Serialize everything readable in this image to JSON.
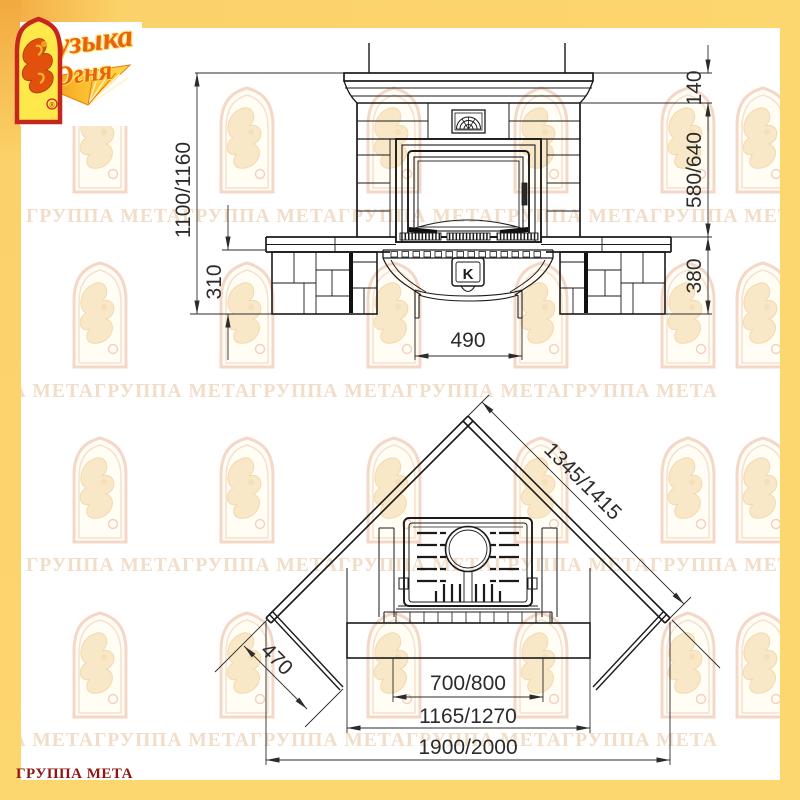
{
  "page": {
    "border_color": "#fcd66e",
    "background": "#ffffff",
    "line_color": "#1a1a1a"
  },
  "brand": {
    "logo_line1": "Музыка",
    "logo_line2": "Огня",
    "group_label": "ГРУППА МЕТА",
    "registered": "®",
    "accent_red": "#c5271f",
    "logo_yellow": "#ffe94a",
    "flame_orange": "#e2500e"
  },
  "watermark": {
    "unit": "ГРУППА МЕТА",
    "row_text": "ГРУППА МЕТАГРУППА МЕТАГРУППА МЕТАГРУППА МЕТАГРУППА МЕТА",
    "color": "#f1ddc8"
  },
  "front_view": {
    "emblem_letter": "K",
    "dim_total_height": "1100/1160",
    "dim_plinth_height": "310",
    "dim_mantel_height": "140",
    "dim_firebox_height": "580/640",
    "dim_base_height": "380",
    "dim_pedestal_width": "490"
  },
  "plan_view": {
    "dim_wall_length": "1345/1415",
    "dim_side_face": "470",
    "dim_opening_width": "700/800",
    "dim_hearth_width": "1165/1270",
    "dim_overall_width": "1900/2000"
  }
}
